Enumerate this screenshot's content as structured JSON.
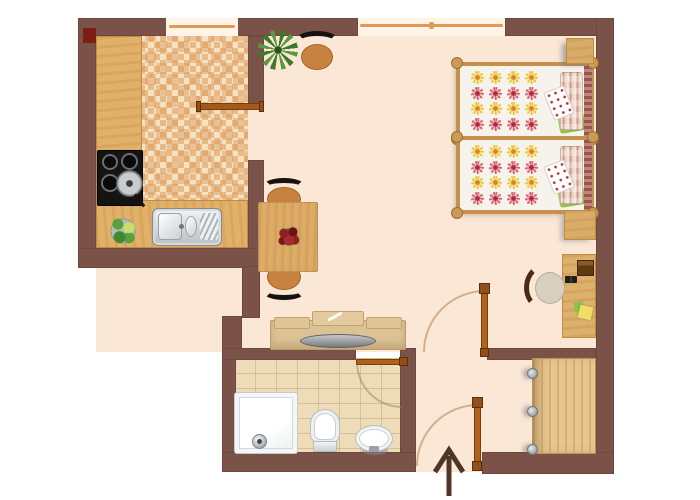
{
  "scene": {
    "type": "apartment-floor-plan",
    "view": "top-down",
    "entrance_direction": "up"
  },
  "palette": {
    "wall": "#7b5248",
    "floor": "#fbe7d5",
    "kitchen_tile": "#f5e2c2",
    "bathroom_tile": "#eedcb8",
    "wood_counter": "#e2b169",
    "wood_furniture": "#dcc295",
    "window_frame": "#e09a55",
    "door_leaf": "#b0611c",
    "arrow": "#4f3526",
    "blanket_green": "#8fbc45",
    "wall_marker_red": "#7e1d12"
  },
  "rooms": [
    {
      "name": "kitchen"
    },
    {
      "name": "living-dining-area"
    },
    {
      "name": "sleeping-area"
    },
    {
      "name": "bathroom"
    },
    {
      "name": "entrance-hall"
    }
  ],
  "furniture": {
    "kitchen": [
      "counter",
      "stove-with-pan",
      "double-sink",
      "vegetable-plate",
      "window"
    ],
    "living": [
      "potted-plant",
      "wall-chair",
      "dining-table",
      "flower-centerpiece",
      "dining-chair-north",
      "dining-chair-south",
      "tv-cabinet",
      "sliding-door"
    ],
    "sleeping": [
      "twin-bed-1",
      "twin-bed-2",
      "nightstand-top",
      "nightstand-middle",
      "desk",
      "desk-chair",
      "window"
    ],
    "bathroom": [
      "shower-tray",
      "toilet",
      "washbasin",
      "bathroom-door"
    ],
    "hall": [
      "wardrobe",
      "interior-door",
      "entrance-door",
      "entrance-arrow"
    ]
  },
  "beds": {
    "count": 2,
    "flower_grid": {
      "columns": 4,
      "rows": [
        "yellow",
        "pink",
        "yellow",
        "pink"
      ]
    },
    "flower_colors": {
      "yellow": {
        "petal": "#e9c832",
        "center": "#dd8128"
      },
      "pink": {
        "petal": "#d95f6e",
        "center": "#a72c3e"
      }
    },
    "pillow_style": "striped",
    "blanket_color": "green"
  }
}
